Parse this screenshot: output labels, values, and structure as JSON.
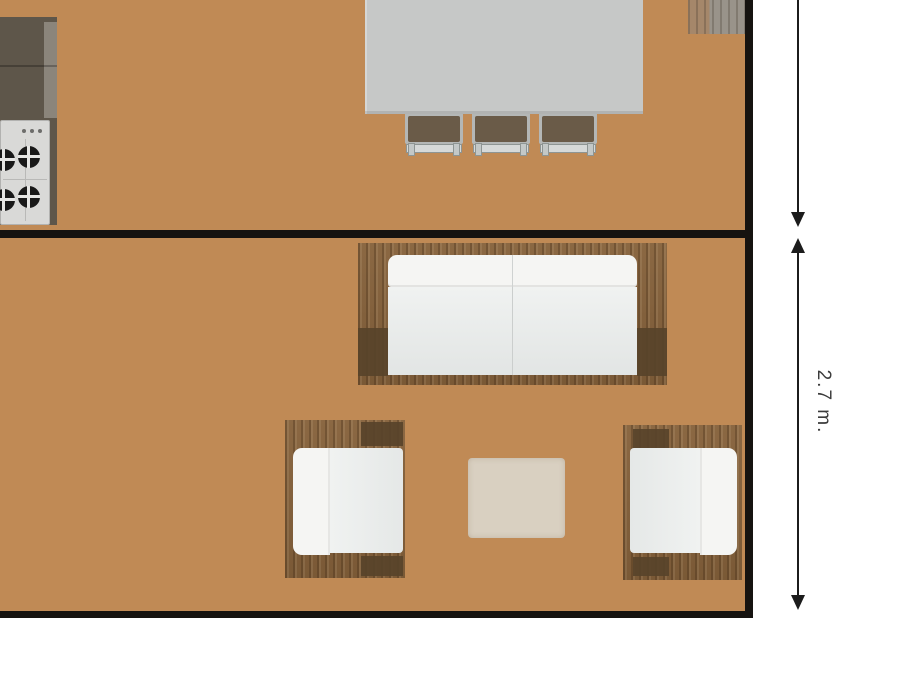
{
  "dimension": {
    "label": "2.7 m."
  },
  "rooms": [
    {
      "id": "kitchen-dining-room"
    },
    {
      "id": "living-room"
    }
  ],
  "furniture": [
    {
      "id": "kitchen-counter"
    },
    {
      "id": "gas-stove",
      "burners": 4
    },
    {
      "id": "dining-table"
    },
    {
      "id": "dining-chair",
      "count": 3
    },
    {
      "id": "wall-cabinet"
    },
    {
      "id": "sofa",
      "seats": 2
    },
    {
      "id": "armchair-left"
    },
    {
      "id": "armchair-right"
    },
    {
      "id": "rug"
    }
  ],
  "colors": {
    "background": "#ffffff",
    "wall": "#161310",
    "wood_base": "#c08a55",
    "counter": "#5e564a",
    "counter_edge": "#8b857b",
    "stove_body": "#d9d9d7",
    "burner": "#191919",
    "table": "#c6c8c7",
    "chair_seat": "#6a5b48",
    "chair_rail": "#d6d9d8",
    "cabinet": "#99938a",
    "sofa_frame": "#8b6843",
    "sofa_frame_dark": "#58432a",
    "cushion_back": "#f5f5f3",
    "cushion_seat": "#e8eaea",
    "rug": "#d9d0c1",
    "dimension_line": "#1c1c1c",
    "dimension_text": "#3b3b3b"
  }
}
